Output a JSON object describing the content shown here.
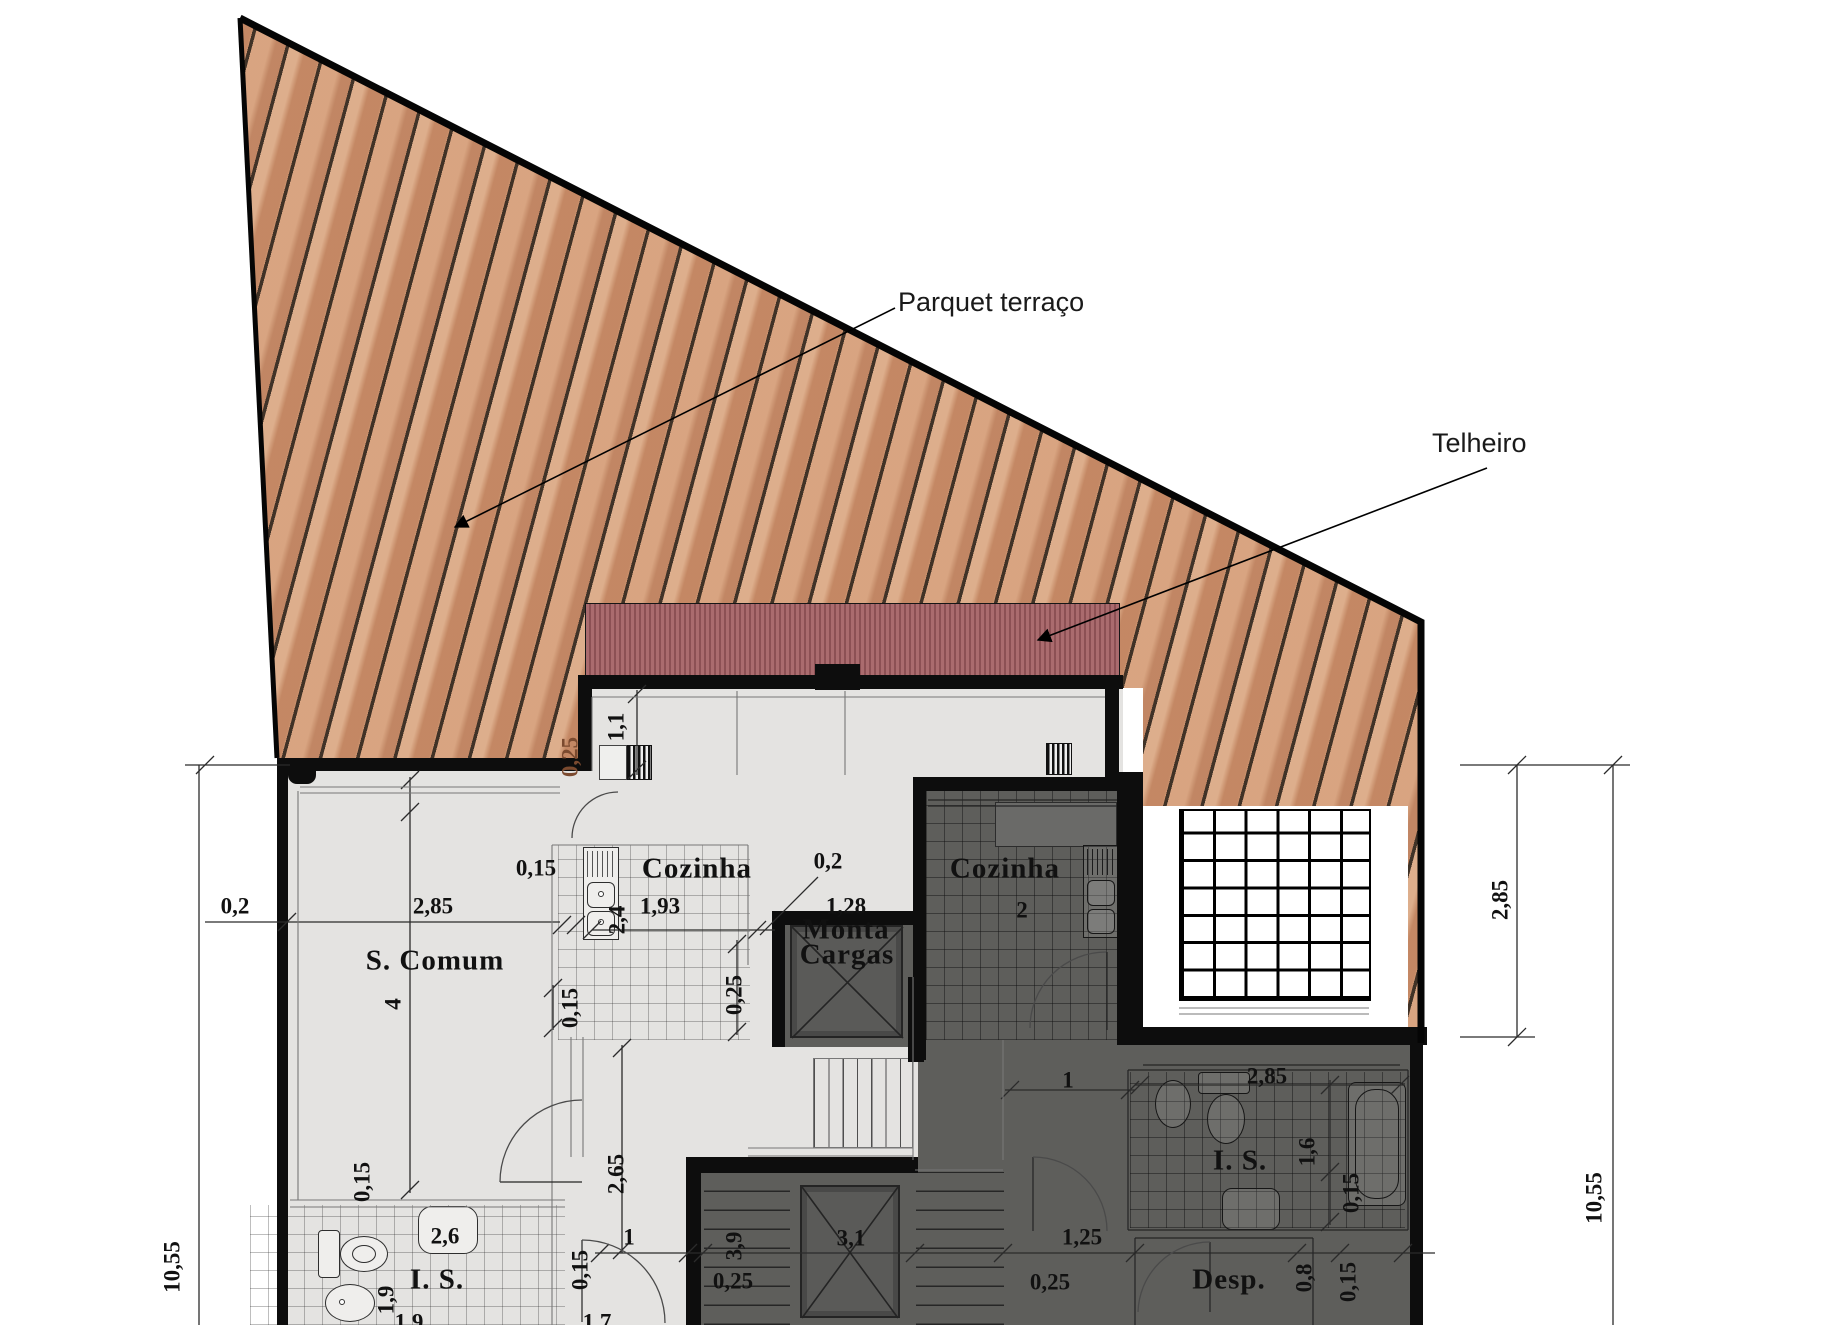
{
  "callouts": {
    "parquet": "Parquet terraço",
    "telheiro": "Telheiro"
  },
  "colors": {
    "deck_wood": "#cf9572",
    "deck_plank_line": "#382c22",
    "roof_red": "#aa6b6e",
    "roof_stripe": "#8c5054",
    "light_floor": "#e4e3e1",
    "dark_floor": "#5e5e5b",
    "wall": "#0d0d0d",
    "dim_text": "#111111",
    "deck_dim_text": "#7b4a2f"
  },
  "rooms": [
    "S. Comum",
    "Cozinha",
    "Cozinha 2",
    "Monta Cargas",
    "I. S.",
    "I. S.",
    "Desp."
  ],
  "labels": [
    {
      "t": "Cozinha",
      "x": 697,
      "y": 869,
      "cls": "room",
      "name": "room-label-cozinha-1"
    },
    {
      "t": "Cozinha",
      "x": 1005,
      "y": 869,
      "cls": "room",
      "name": "room-label-cozinha-2"
    },
    {
      "t": "2",
      "x": 1022,
      "y": 910,
      "name": "room-number-cozinha-2"
    },
    {
      "t": "S. Comum",
      "x": 435,
      "y": 961,
      "cls": "room",
      "name": "room-label-s-comum"
    },
    {
      "t": "4",
      "x": 393,
      "y": 1004,
      "rot": -90,
      "name": "dim-label"
    },
    {
      "t": "Monta",
      "x": 846,
      "y": 930,
      "cls": "room",
      "name": "room-label-monta-cargas-1"
    },
    {
      "t": "Cargas",
      "x": 847,
      "y": 955,
      "cls": "room",
      "name": "room-label-monta-cargas-2"
    },
    {
      "t": "I. S.",
      "x": 437,
      "y": 1280,
      "cls": "room",
      "name": "room-label-is-1"
    },
    {
      "t": "I. S.",
      "x": 1240,
      "y": 1161,
      "cls": "room",
      "name": "room-label-is-2"
    },
    {
      "t": "Desp.",
      "x": 1229,
      "y": 1280,
      "cls": "room",
      "name": "room-label-desp"
    },
    {
      "t": "0,15",
      "x": 536,
      "y": 868,
      "name": "dim-label"
    },
    {
      "t": "1,93",
      "x": 660,
      "y": 906,
      "name": "dim-label"
    },
    {
      "t": "2,4",
      "x": 617,
      "y": 920,
      "rot": -90,
      "name": "dim-label"
    },
    {
      "t": "0,2",
      "x": 828,
      "y": 861,
      "name": "dim-label"
    },
    {
      "t": "1,28",
      "x": 846,
      "y": 906,
      "name": "dim-label"
    },
    {
      "t": "1,1",
      "x": 616,
      "y": 727,
      "rot": -90,
      "name": "dim-label"
    },
    {
      "t": "0,25",
      "x": 570,
      "y": 757,
      "rot": -90,
      "color": "#7b4a2f",
      "name": "dim-label-deck"
    },
    {
      "t": "0,25",
      "x": 734,
      "y": 995,
      "rot": -90,
      "name": "dim-label"
    },
    {
      "t": "0,15",
      "x": 570,
      "y": 1008,
      "rot": -90,
      "name": "dim-label"
    },
    {
      "t": "0,15",
      "x": 362,
      "y": 1182,
      "rot": -90,
      "name": "dim-label"
    },
    {
      "t": "2,65",
      "x": 616,
      "y": 1174,
      "rot": -90,
      "name": "dim-label"
    },
    {
      "t": "2,6",
      "x": 445,
      "y": 1236,
      "name": "dim-label"
    },
    {
      "t": "1,9",
      "x": 386,
      "y": 1300,
      "rot": -90,
      "name": "dim-label"
    },
    {
      "t": "1",
      "x": 629,
      "y": 1237,
      "name": "dim-label"
    },
    {
      "t": "0,15",
      "x": 580,
      "y": 1270,
      "rot": -90,
      "name": "dim-label"
    },
    {
      "t": "1,9",
      "x": 409,
      "y": 1322,
      "name": "dim-label"
    },
    {
      "t": "1,7",
      "x": 597,
      "y": 1322,
      "name": "dim-label"
    },
    {
      "t": "3,9",
      "x": 734,
      "y": 1246,
      "rot": -90,
      "name": "dim-label"
    },
    {
      "t": "0,25",
      "x": 733,
      "y": 1281,
      "name": "dim-label"
    },
    {
      "t": "3,1",
      "x": 851,
      "y": 1238,
      "name": "dim-label"
    },
    {
      "t": "1",
      "x": 1068,
      "y": 1080,
      "name": "dim-label"
    },
    {
      "t": "2,85",
      "x": 1267,
      "y": 1076,
      "name": "dim-label"
    },
    {
      "t": "1,6",
      "x": 1307,
      "y": 1152,
      "rot": -90,
      "name": "dim-label"
    },
    {
      "t": "0,15",
      "x": 1351,
      "y": 1193,
      "rot": -90,
      "name": "dim-label"
    },
    {
      "t": "1,25",
      "x": 1082,
      "y": 1237,
      "name": "dim-label"
    },
    {
      "t": "0,25",
      "x": 1050,
      "y": 1282,
      "name": "dim-label"
    },
    {
      "t": "0,8",
      "x": 1304,
      "y": 1278,
      "rot": -90,
      "name": "dim-label"
    },
    {
      "t": "0,15",
      "x": 1348,
      "y": 1282,
      "rot": -90,
      "name": "dim-label"
    },
    {
      "t": "0,2",
      "x": 235,
      "y": 906,
      "name": "dim-label"
    },
    {
      "t": "2,85",
      "x": 433,
      "y": 906,
      "name": "dim-label"
    },
    {
      "t": "10,55",
      "x": 172,
      "y": 1267,
      "rot": -90,
      "name": "dim-label"
    },
    {
      "t": "2,85",
      "x": 1500,
      "y": 900,
      "rot": -90,
      "name": "dim-label"
    },
    {
      "t": "10,55",
      "x": 1594,
      "y": 1198,
      "rot": -90,
      "name": "dim-label"
    }
  ]
}
